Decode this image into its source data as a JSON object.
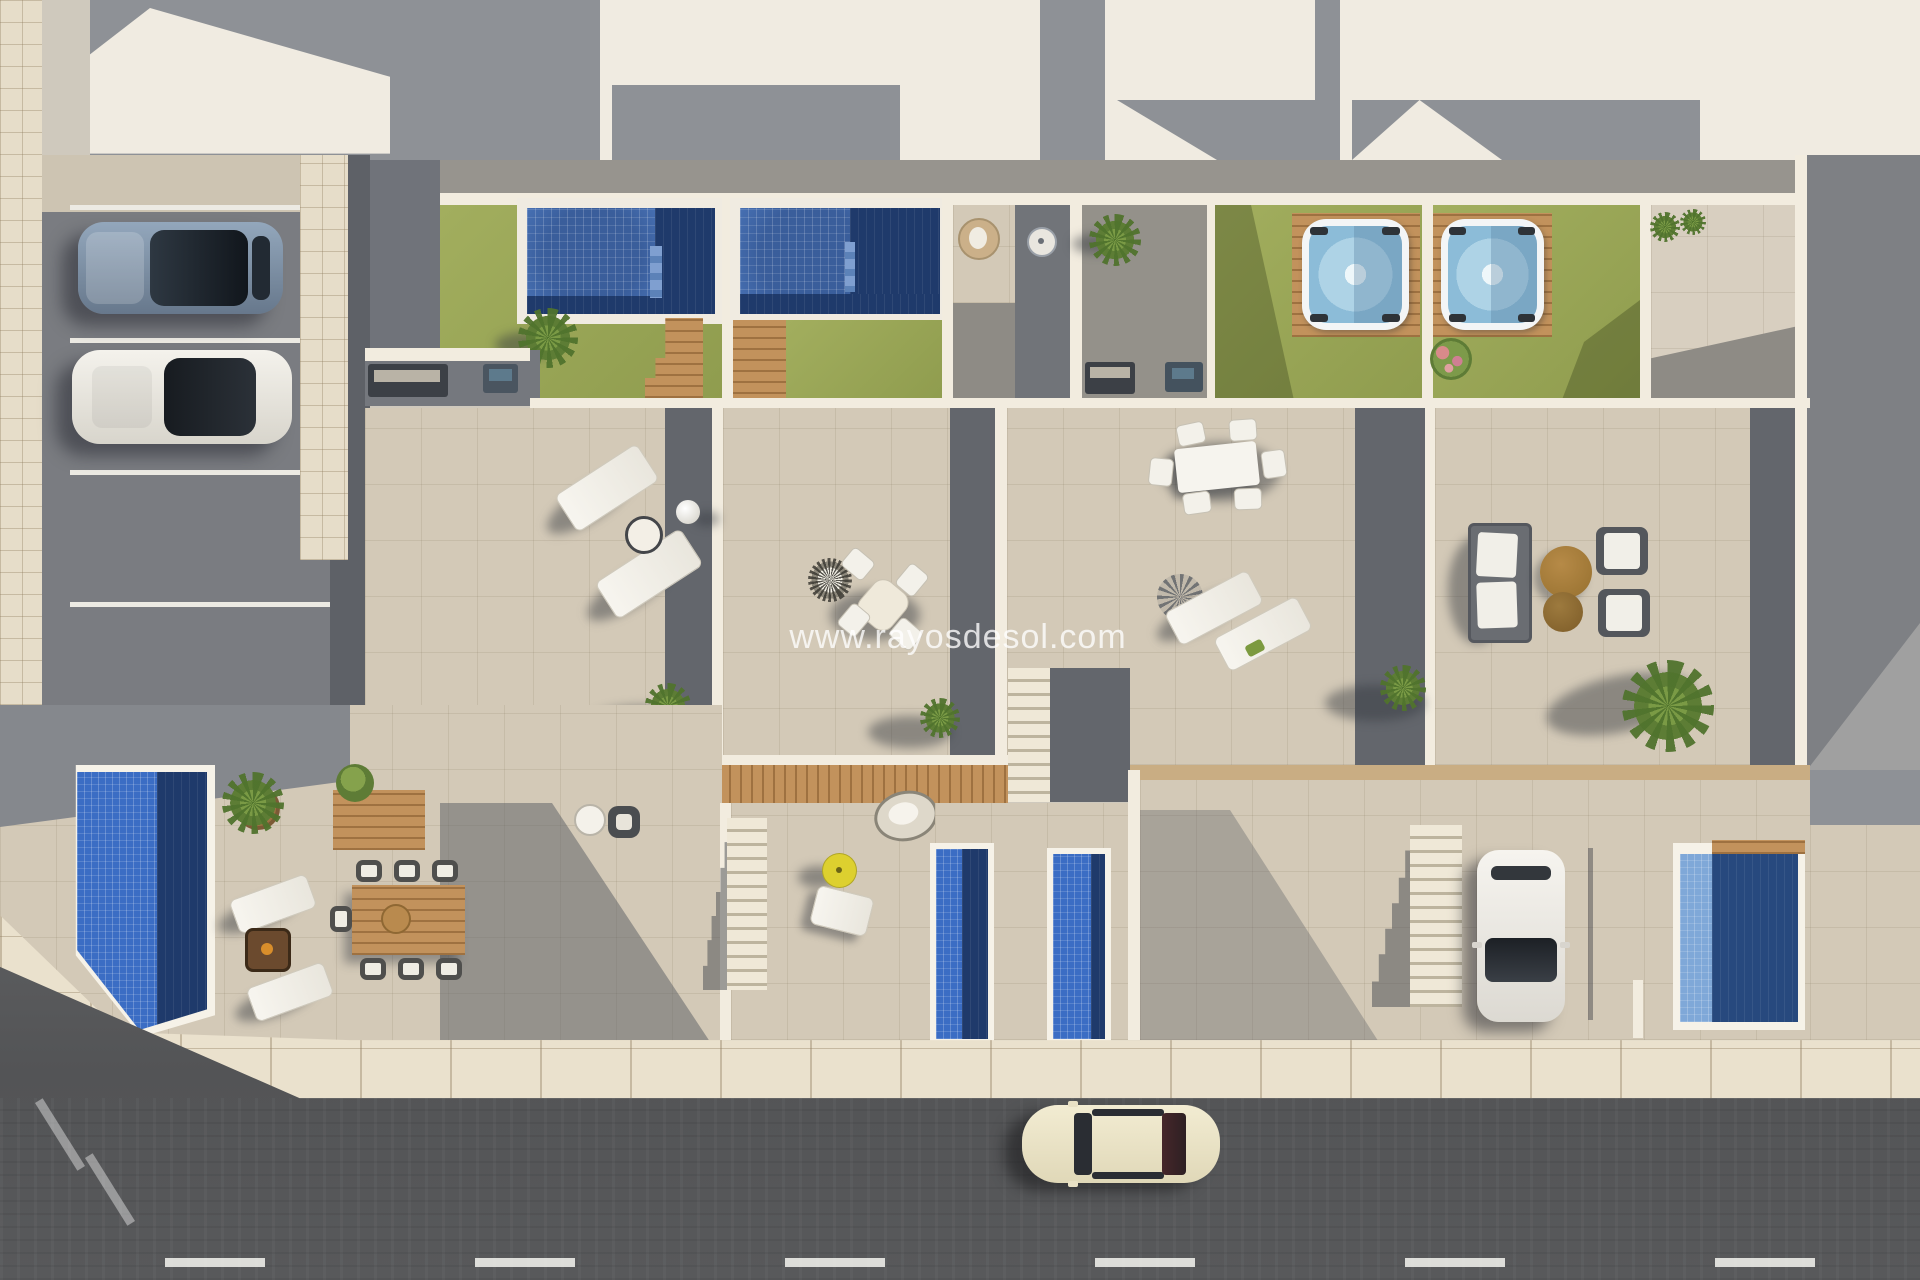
{
  "watermark": {
    "text": "www.rayosdesol.com"
  },
  "palette": {
    "beige": "#d3c9b7",
    "beigeLine": "rgba(120,105,80,0.14)",
    "sidewalk": "#eae1cd",
    "sidewalkLine": "rgba(145,125,95,0.4)",
    "asphaltParking": "#7a7c81",
    "road": "#58595b",
    "lawn": "#a2ae5e",
    "lawnDark": "#8f9c4e",
    "poolTile": "#4a74b8",
    "poolDeep": "#1f3a6b",
    "poolBright": "#3b6dc4",
    "poolLight": "#7fa8d8",
    "tubWater": "#aed3e6",
    "wood": "#c2925c",
    "woodLine": "rgba(100,60,20,0.38)",
    "wall": "#f2ecdf",
    "roofWhite": "#f0ebe1",
    "roofShadow": "#8e9196",
    "grayPatio": "#94918a",
    "grayStrip": "#63666c",
    "darkStrip": "#5e6167",
    "stairLight": "#efe8d7",
    "stairDark": "#bdb49e",
    "parasolYellow": "#ddd02f",
    "tanBand": "#c9ad83",
    "carBlue": "#7d92a8",
    "carCream": "#ece5c8"
  }
}
